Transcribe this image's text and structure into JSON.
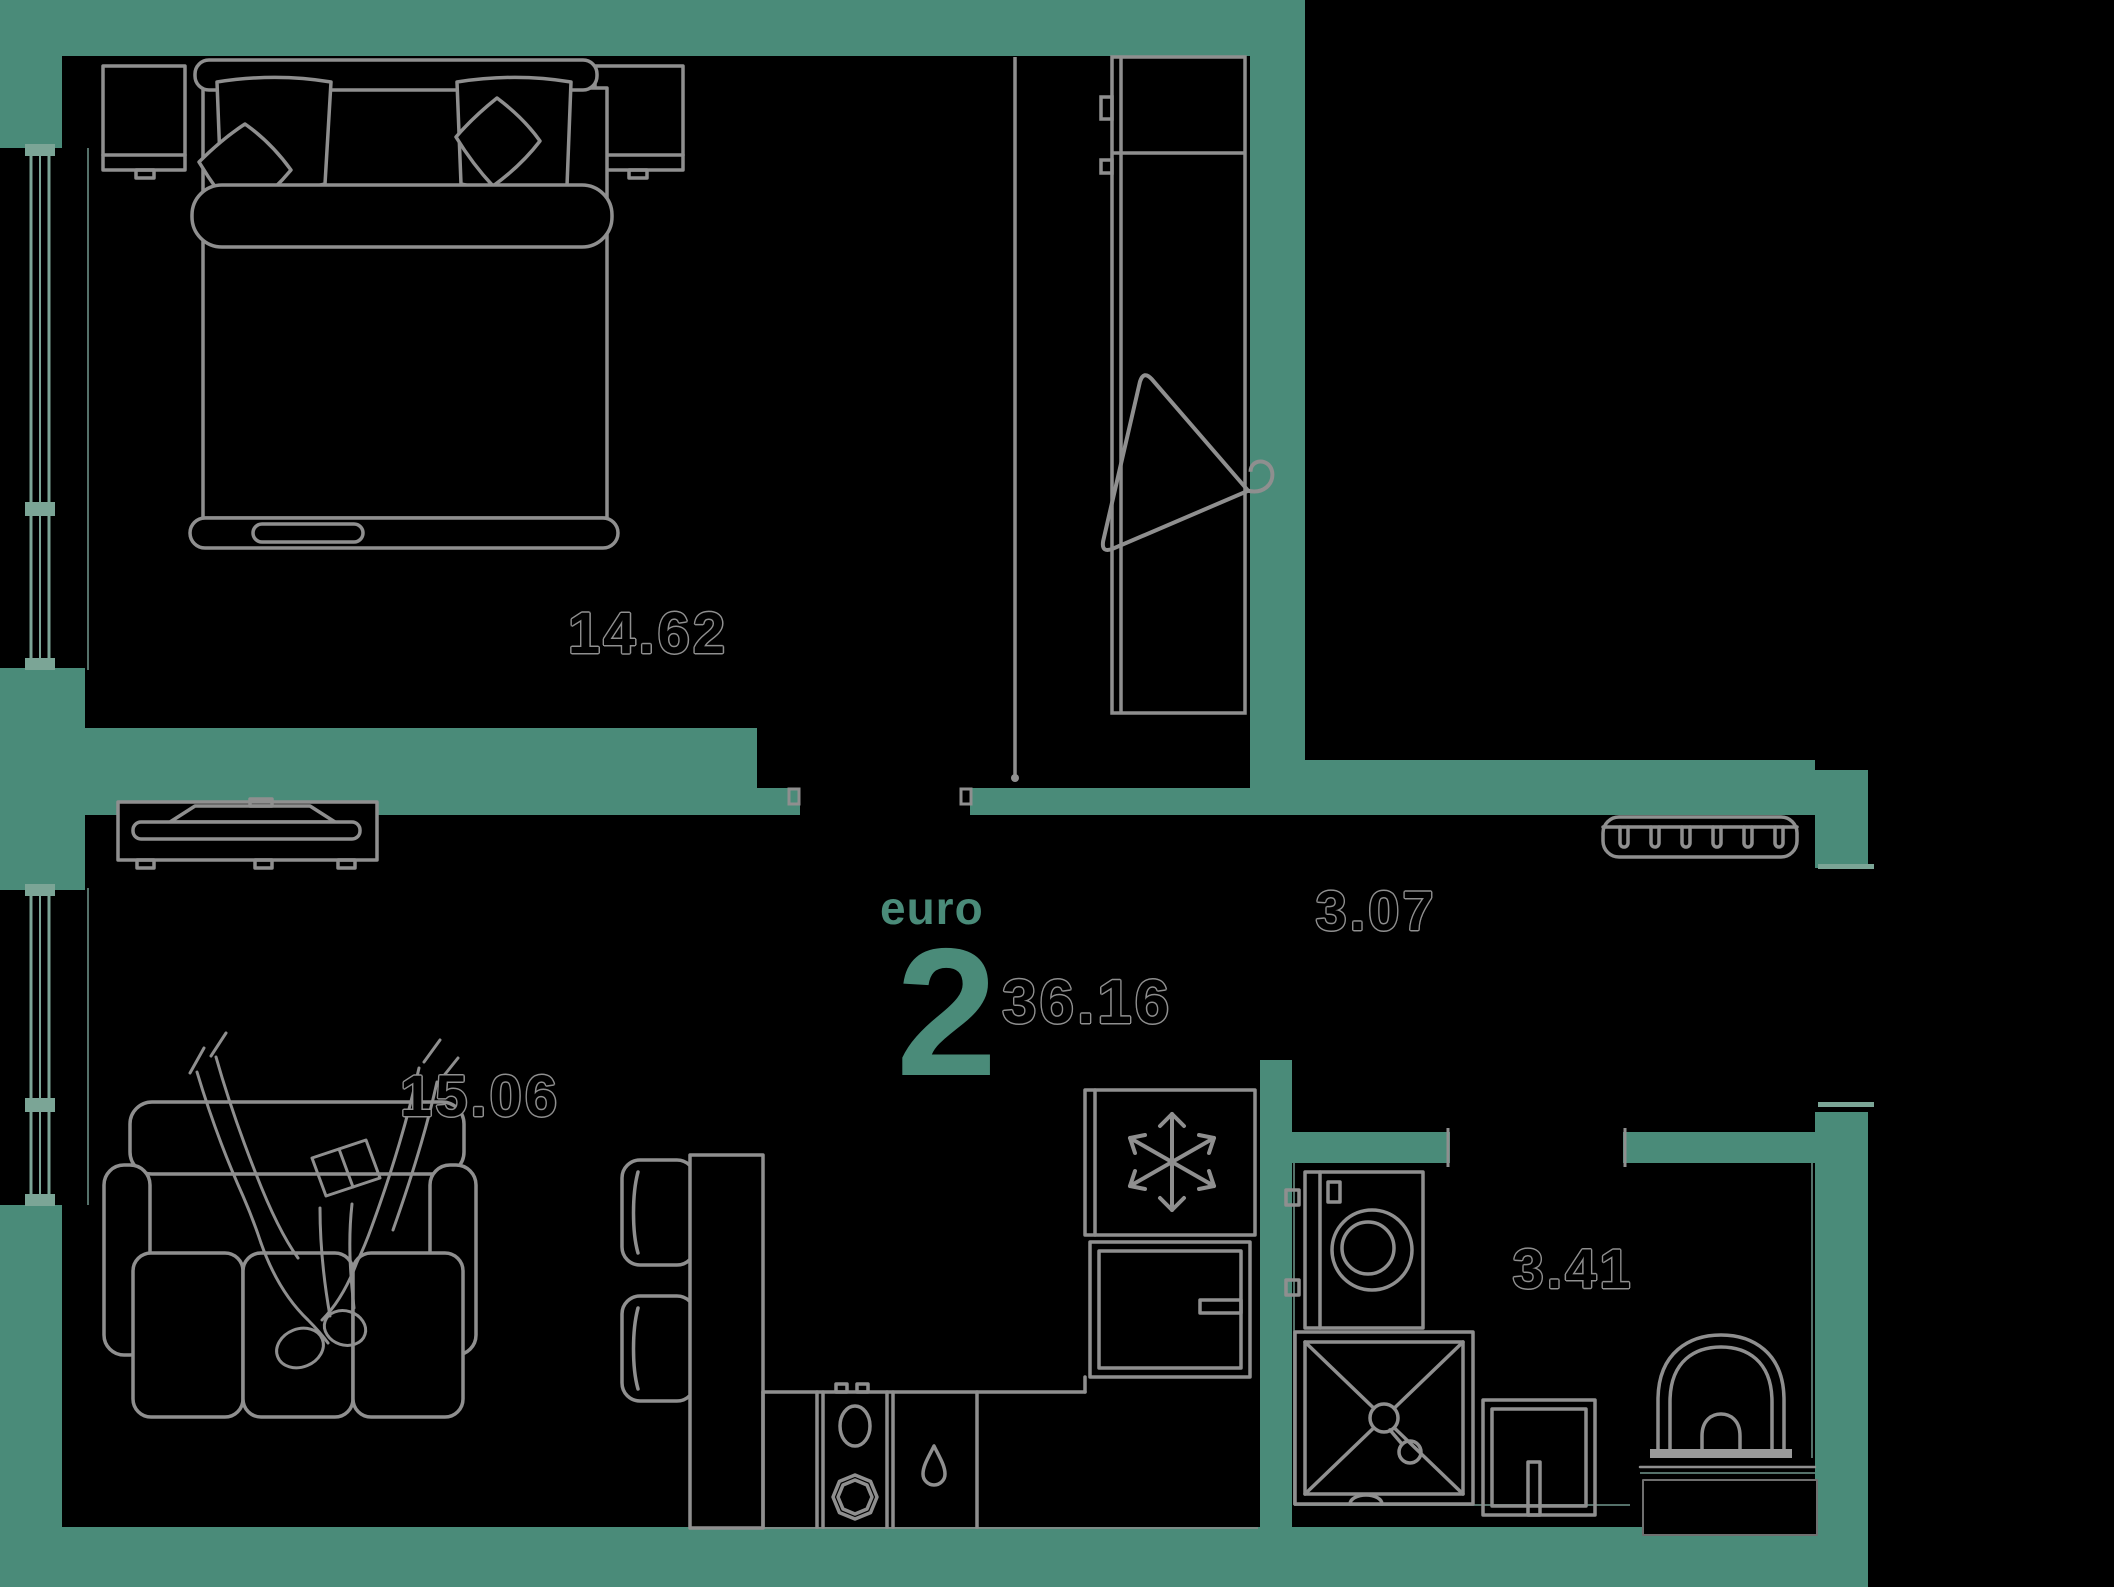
{
  "plan": {
    "type_label": "euro",
    "rooms_count": "2",
    "total_area": "36.16"
  },
  "labels": {
    "bedroom_area": "14.62",
    "living_area": "15.06",
    "hallway_area": "3.07",
    "bathroom_area": "3.41"
  },
  "colors": {
    "wall": "#4A8B79",
    "window": "#7BA596",
    "furniture_line": "#8F8F8F",
    "background": "#000000",
    "label_fill": "#000000",
    "label_outline": "#8F8F8F"
  },
  "icons": {
    "hanger": "clothes-hanger-icon",
    "snowflake": "freezer-snowflake-icon",
    "gas_drop": "gas-point-drop-icon",
    "radiator": "radiator-shelf-icon"
  }
}
